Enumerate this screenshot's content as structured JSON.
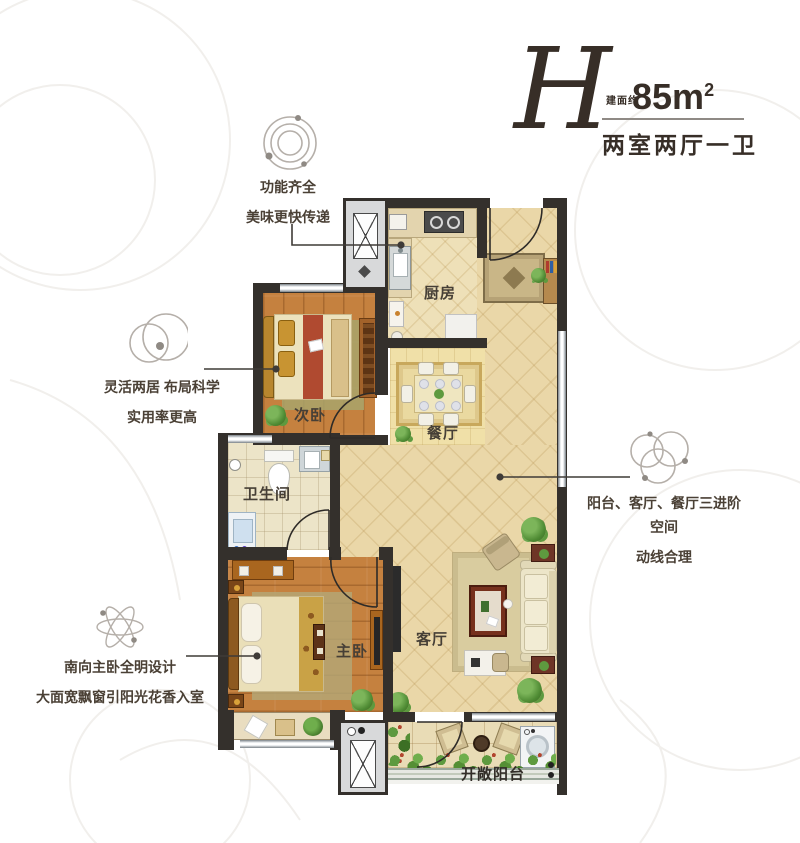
{
  "header": {
    "plan_letter": "H",
    "area_label": "建面约",
    "area_value": "85m",
    "area_sup": "2",
    "subtitle": "两室两厅一卫"
  },
  "annotations": [
    {
      "id": "kitchen",
      "icon": "orbit-rings-icon",
      "lines": [
        "功能齐全",
        "美味更快传递"
      ]
    },
    {
      "id": "bedroom",
      "icon": "overlap-circles-icon",
      "lines": [
        "灵活两居 布局科学",
        "实用率更高"
      ]
    },
    {
      "id": "master",
      "icon": "atom-orbits-icon",
      "lines": [
        "南向主卧全明设计",
        "大面宽飘窗引阳光花香入室"
      ]
    },
    {
      "id": "living",
      "icon": "triple-circles-icon",
      "lines": [
        "阳台、客厅、餐厅三进阶空间",
        "动线合理"
      ]
    }
  ],
  "rooms": {
    "kitchen": "厨房",
    "second_bedroom": "次卧",
    "dining": "餐厅",
    "bathroom": "卫生间",
    "master_bedroom": "主卧",
    "living_room": "客厅",
    "balcony": "开敞阳台"
  },
  "colors": {
    "title_text": "#372e27",
    "wall": "#34302c",
    "annotation_text": "#4a4035",
    "annotation_line": "#3f3b37",
    "icon_stroke": "#b5afa9",
    "tile_floor": "#ead7a8",
    "wood_floor": "#c5813f",
    "window": "#e8ebed"
  }
}
